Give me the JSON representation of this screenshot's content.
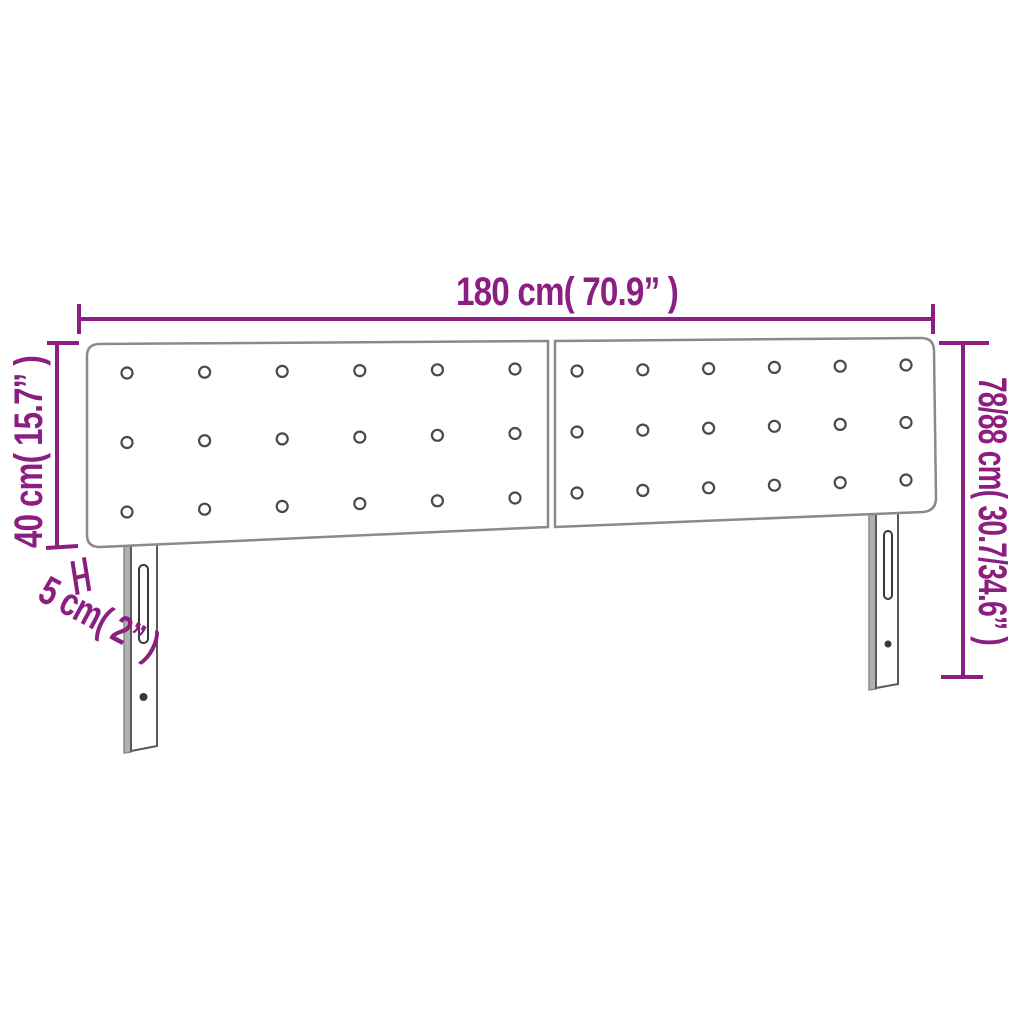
{
  "page": {
    "background_color": "#ffffff"
  },
  "diagram": {
    "type": "product-dimensions",
    "subject": "button-tufted headboard with two upholstered panels and two slotted legs",
    "accent_color": "#8B1E80",
    "outline_color": "#8a8a8a",
    "labels": {
      "width": "180 cm( 70.9” )",
      "height": "40 cm( 15.7” )",
      "depth": "5 cm( 2” )",
      "total_height": "78/88 cm( 30.7/34.6” )"
    },
    "headboard": {
      "panels": 2,
      "button_rows": 3,
      "button_cols_per_panel": 6,
      "legs": 2
    }
  }
}
